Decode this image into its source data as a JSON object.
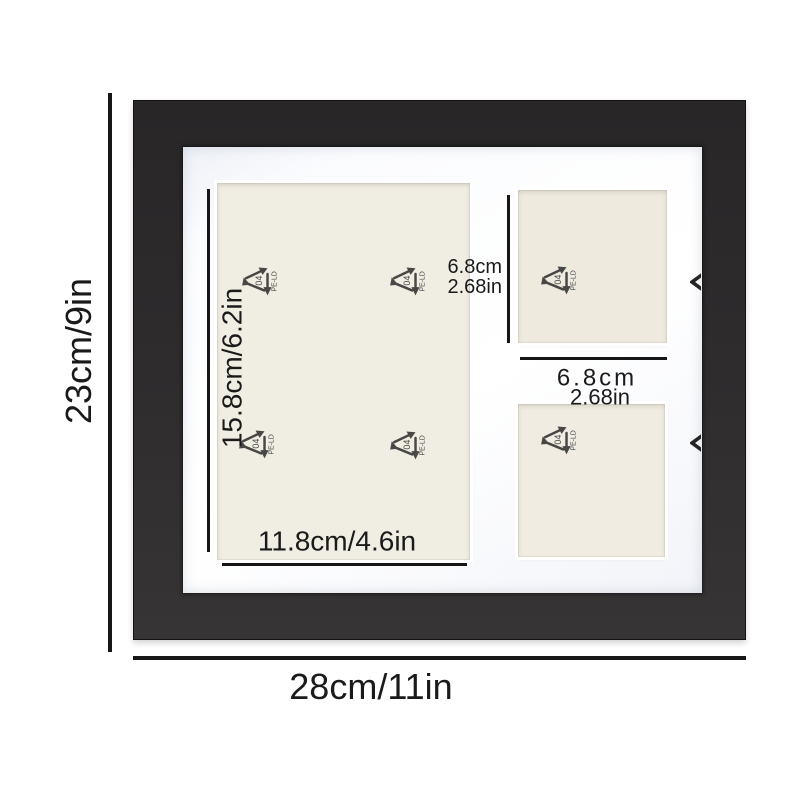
{
  "page": {
    "type": "product-dimension-diagram",
    "background_color": "#ffffff"
  },
  "frame": {
    "frame_color": "#2e2c2d",
    "mat_color": "#fbfcfe",
    "backing_color": "#efece2",
    "line_color": "#161616"
  },
  "dimensions": {
    "outer_height": "23cm/9in",
    "outer_width": "28cm/11in",
    "large_opening_height": "15.8cm/6.2in",
    "large_opening_width": "11.8cm/4.6in",
    "small_opening_height_cm": "6.8cm",
    "small_opening_height_in": "2.68in",
    "small_opening_width_cm": "6.8cm",
    "small_opening_width_in": "2.68in"
  },
  "recycle_icon": {
    "code": "04",
    "material": "PE-LD"
  }
}
